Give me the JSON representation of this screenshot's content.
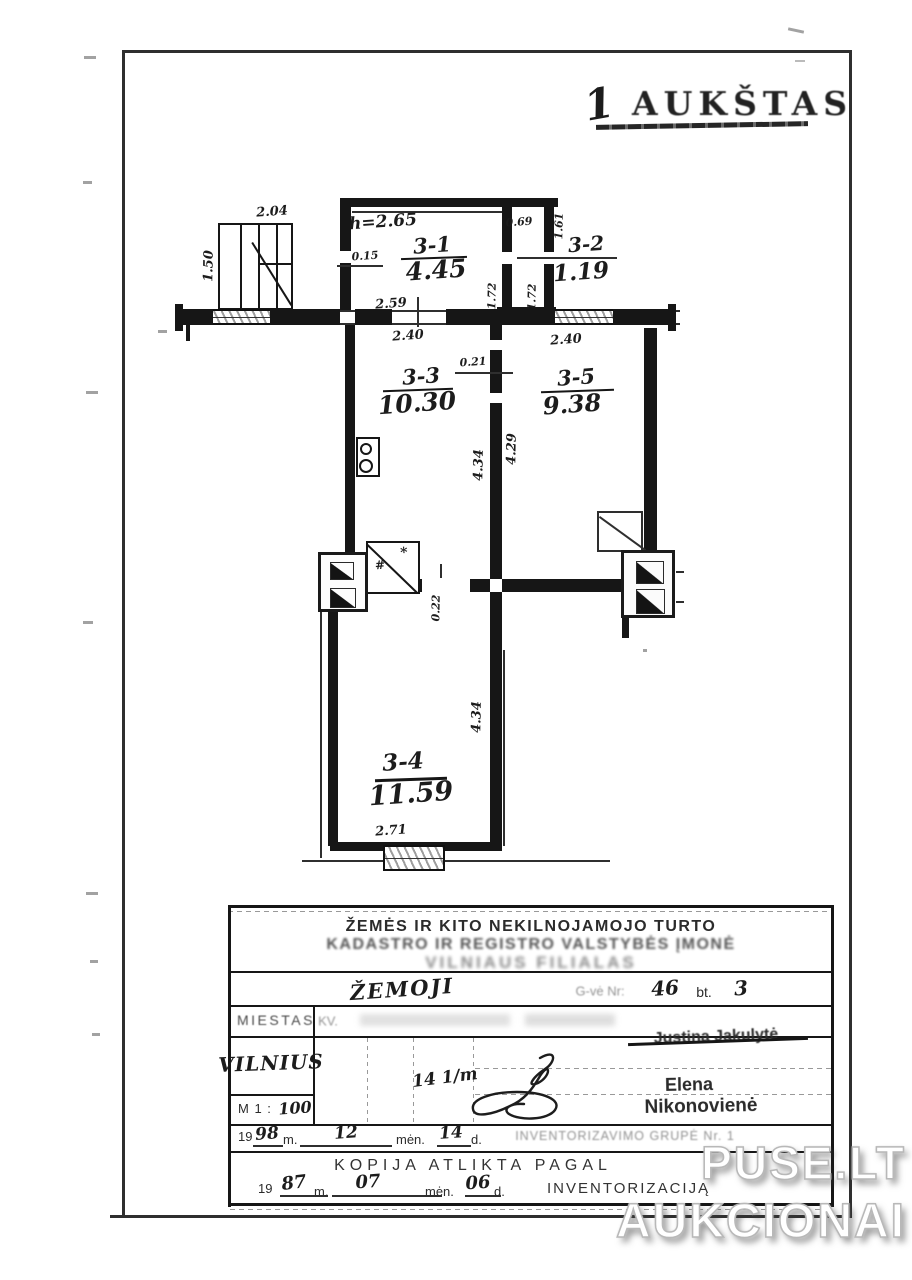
{
  "page": {
    "title_number": "1",
    "title_text": "AUKŠTAS"
  },
  "plan": {
    "rooms": [
      {
        "id": "3-1",
        "area": "4.45"
      },
      {
        "id": "3-2",
        "area": "1.19"
      },
      {
        "id": "3-3",
        "area": "10.30"
      },
      {
        "id": "3-5",
        "area": "9.38"
      },
      {
        "id": "3-4",
        "area": "11.59"
      }
    ],
    "dims": {
      "d204": "2.04",
      "d150": "1.50",
      "h265": "h=2.65",
      "d015": "0.15",
      "d069": "0.69",
      "d161": "1.61",
      "d172a": "1.72",
      "d172b": "1.72",
      "d259": "2.59",
      "d240a": "2.40",
      "d021": "0.21",
      "d240b": "2.40",
      "d434a": "4.34",
      "d429": "4.29",
      "d022": "0.22",
      "d434b": "4.34",
      "d271": "2.71"
    },
    "closet_marks": {
      "hash": "#",
      "star": "*"
    }
  },
  "titleblock": {
    "org_line1": "ŽEMĖS IR KITO NEKILNOJAMOJO TURTO",
    "org_line2": "KADASTRO IR REGISTRO VALSTYBĖS ĮMONĖ",
    "org_line3": "VILNIAUS FILIALAS",
    "street_name": "ŽEMOJI",
    "street_label": "G-vė Nr:",
    "house_no": "46",
    "flat_label": "bt.",
    "flat_no": "3",
    "city_label": "MIESTAS",
    "kv_label": "KV.",
    "crossed_name": "Justina Jakulytė",
    "city_value": "VILNIUS",
    "scale_label": "M 1 :",
    "scale_value": "100",
    "note_value": "14 1/m",
    "stamp_name_line1": "Elena",
    "stamp_name_line2": "Nikonovienė",
    "date1": {
      "prefix": "19",
      "year": "98",
      "m_label": "m.",
      "month": "12",
      "men_label": "mėn.",
      "day": "14",
      "d_label": "d."
    },
    "group_label": "INVENTORIZAVIMO GRUPĖ Nr. 1",
    "copy_title": "KOPIJA ATLIKTA PAGAL",
    "date2": {
      "prefix": "19",
      "year": "87",
      "m_label": "m.",
      "month": "07",
      "men_label": "mėn.",
      "day": "06",
      "d_label": "d."
    },
    "copy_suffix": "INVENTORIZACIJĄ"
  },
  "watermark": {
    "line1": "PUSE.LT",
    "line2": "AUKCIONAI"
  }
}
